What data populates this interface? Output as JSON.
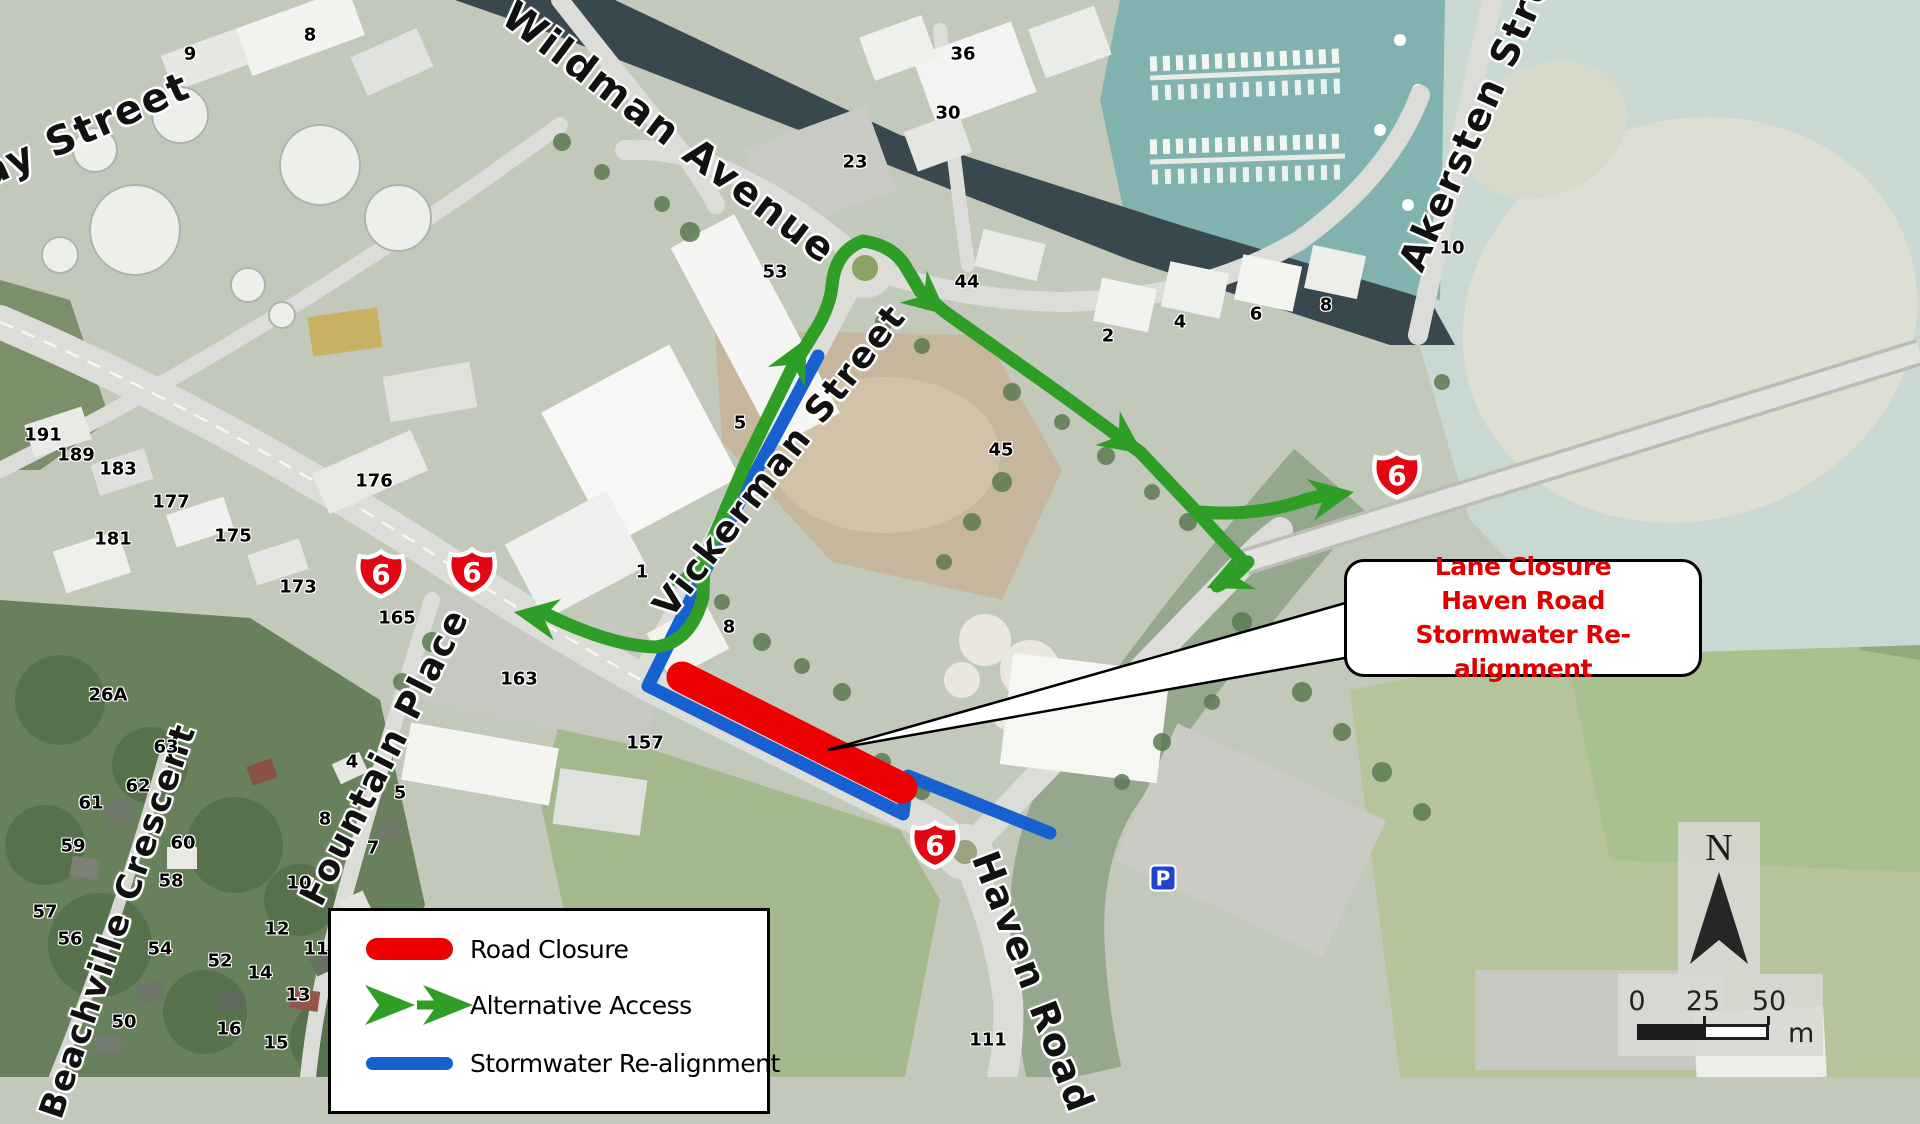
{
  "map": {
    "colors": {
      "closure": "#ee0000",
      "access": "#2e9e26",
      "stormwater": "#1660d0",
      "shield": "#e30613",
      "callout_text": "#e00000"
    },
    "shield_number": "6",
    "north_label": "N",
    "parking": {
      "label": "P",
      "x": 1163,
      "y": 878
    },
    "callout": {
      "lines": [
        "Lane Closure",
        "Haven Road",
        "Stormwater Re-alignment"
      ],
      "x": 1344,
      "y": 559,
      "w": 352,
      "h": 112,
      "tail_points": "1356,600 828,750 1356,656"
    },
    "legend": {
      "x": 328,
      "y": 908,
      "w": 436,
      "h": 200,
      "items": [
        {
          "symbol": "road-closure",
          "label": "Road Closure"
        },
        {
          "symbol": "alternative-access",
          "label": "Alternative Access"
        },
        {
          "symbol": "stormwater-realignment",
          "label": "Stormwater Re-alignment"
        }
      ]
    },
    "scalebar": {
      "ticks": [
        "0",
        "25",
        "50"
      ],
      "unit": "m"
    },
    "street_labels": [
      {
        "text": "Hay Street",
        "x": 69,
        "y": 137,
        "rot": -24,
        "size": 40
      },
      {
        "text": "Wildman Avenue",
        "x": 669,
        "y": 133,
        "rot": 37,
        "size": 40
      },
      {
        "text": "Akersten Street",
        "x": 1485,
        "y": 100,
        "rot": -66,
        "size": 38
      },
      {
        "text": "Vickerman Street",
        "x": 780,
        "y": 461,
        "rot": -52,
        "size": 36
      },
      {
        "text": "Fountain Place",
        "x": 385,
        "y": 757,
        "rot": -63,
        "size": 36
      },
      {
        "text": "Beachville Crescent",
        "x": 118,
        "y": 921,
        "rot": -71,
        "size": 34
      },
      {
        "text": "Haven Road",
        "x": 1033,
        "y": 982,
        "rot": 69,
        "size": 38
      }
    ],
    "number_labels": [
      {
        "t": "9",
        "x": 190,
        "y": 54
      },
      {
        "t": "8",
        "x": 310,
        "y": 35
      },
      {
        "t": "36",
        "x": 963,
        "y": 54
      },
      {
        "t": "30",
        "x": 948,
        "y": 113
      },
      {
        "t": "23",
        "x": 855,
        "y": 162
      },
      {
        "t": "53",
        "x": 775,
        "y": 272
      },
      {
        "t": "44",
        "x": 967,
        "y": 282
      },
      {
        "t": "10",
        "x": 1452,
        "y": 248
      },
      {
        "t": "8",
        "x": 1326,
        "y": 305
      },
      {
        "t": "6",
        "x": 1256,
        "y": 314
      },
      {
        "t": "4",
        "x": 1180,
        "y": 322
      },
      {
        "t": "2",
        "x": 1108,
        "y": 336
      },
      {
        "t": "45",
        "x": 1001,
        "y": 450
      },
      {
        "t": "5",
        "x": 740,
        "y": 423
      },
      {
        "t": "1",
        "x": 642,
        "y": 572
      },
      {
        "t": "8",
        "x": 729,
        "y": 627
      },
      {
        "t": "191",
        "x": 43,
        "y": 435
      },
      {
        "t": "189",
        "x": 76,
        "y": 455
      },
      {
        "t": "183",
        "x": 118,
        "y": 469
      },
      {
        "t": "177",
        "x": 171,
        "y": 502
      },
      {
        "t": "176",
        "x": 374,
        "y": 481
      },
      {
        "t": "175",
        "x": 233,
        "y": 536
      },
      {
        "t": "181",
        "x": 113,
        "y": 539
      },
      {
        "t": "173",
        "x": 298,
        "y": 587
      },
      {
        "t": "165",
        "x": 397,
        "y": 618
      },
      {
        "t": "163",
        "x": 519,
        "y": 679
      },
      {
        "t": "157",
        "x": 645,
        "y": 743
      },
      {
        "t": "26A",
        "x": 108,
        "y": 695
      },
      {
        "t": "63",
        "x": 166,
        "y": 747
      },
      {
        "t": "62",
        "x": 138,
        "y": 786
      },
      {
        "t": "61",
        "x": 91,
        "y": 803
      },
      {
        "t": "59",
        "x": 73,
        "y": 846
      },
      {
        "t": "60",
        "x": 183,
        "y": 843
      },
      {
        "t": "58",
        "x": 171,
        "y": 881
      },
      {
        "t": "10",
        "x": 299,
        "y": 883
      },
      {
        "t": "12",
        "x": 277,
        "y": 929
      },
      {
        "t": "11",
        "x": 316,
        "y": 949
      },
      {
        "t": "54",
        "x": 160,
        "y": 949
      },
      {
        "t": "14",
        "x": 260,
        "y": 973
      },
      {
        "t": "13",
        "x": 298,
        "y": 995
      },
      {
        "t": "16",
        "x": 229,
        "y": 1029
      },
      {
        "t": "50",
        "x": 124,
        "y": 1022
      },
      {
        "t": "15",
        "x": 276,
        "y": 1043
      },
      {
        "t": "57",
        "x": 45,
        "y": 912
      },
      {
        "t": "56",
        "x": 70,
        "y": 939
      },
      {
        "t": "52",
        "x": 220,
        "y": 961
      },
      {
        "t": "4",
        "x": 352,
        "y": 762
      },
      {
        "t": "5",
        "x": 400,
        "y": 793
      },
      {
        "t": "8",
        "x": 325,
        "y": 819
      },
      {
        "t": "7",
        "x": 373,
        "y": 848
      },
      {
        "t": "111",
        "x": 988,
        "y": 1040
      }
    ],
    "shields": [
      {
        "x": 381,
        "y": 574
      },
      {
        "x": 472,
        "y": 572
      },
      {
        "x": 1397,
        "y": 475
      },
      {
        "x": 935,
        "y": 845
      }
    ],
    "routes": {
      "closure": "M682,677 L902,788",
      "stormwater": "M818,356 L730,520 L648,686 L903,814 L908,776 L1050,833",
      "access": [
        "M550,616 Q612,646 656,647 Q691,642 703,597 L704,560 L746,462 L791,370 L818,326 Q830,305 832,286 Q835,251 863,241 Q891,245 904,264 Q912,277 920,291 L945,312 L1058,392 L1140,452 L1195,510 Q1222,540 1242,560",
        "M1248,562 Q1233,579 1217,586",
        "M1198,512 Q1258,517 1308,499 L1334,493"
      ],
      "access_arrowheads": [
        {
          "x": 514,
          "y": 612,
          "a": 190
        },
        {
          "x": 702,
          "y": 552,
          "a": -72
        },
        {
          "x": 807,
          "y": 338,
          "a": -62
        },
        {
          "x": 947,
          "y": 315,
          "a": 40
        },
        {
          "x": 1143,
          "y": 454,
          "a": 36
        },
        {
          "x": 1207,
          "y": 588,
          "a": 156
        },
        {
          "x": 1354,
          "y": 492,
          "a": -10
        }
      ]
    }
  }
}
